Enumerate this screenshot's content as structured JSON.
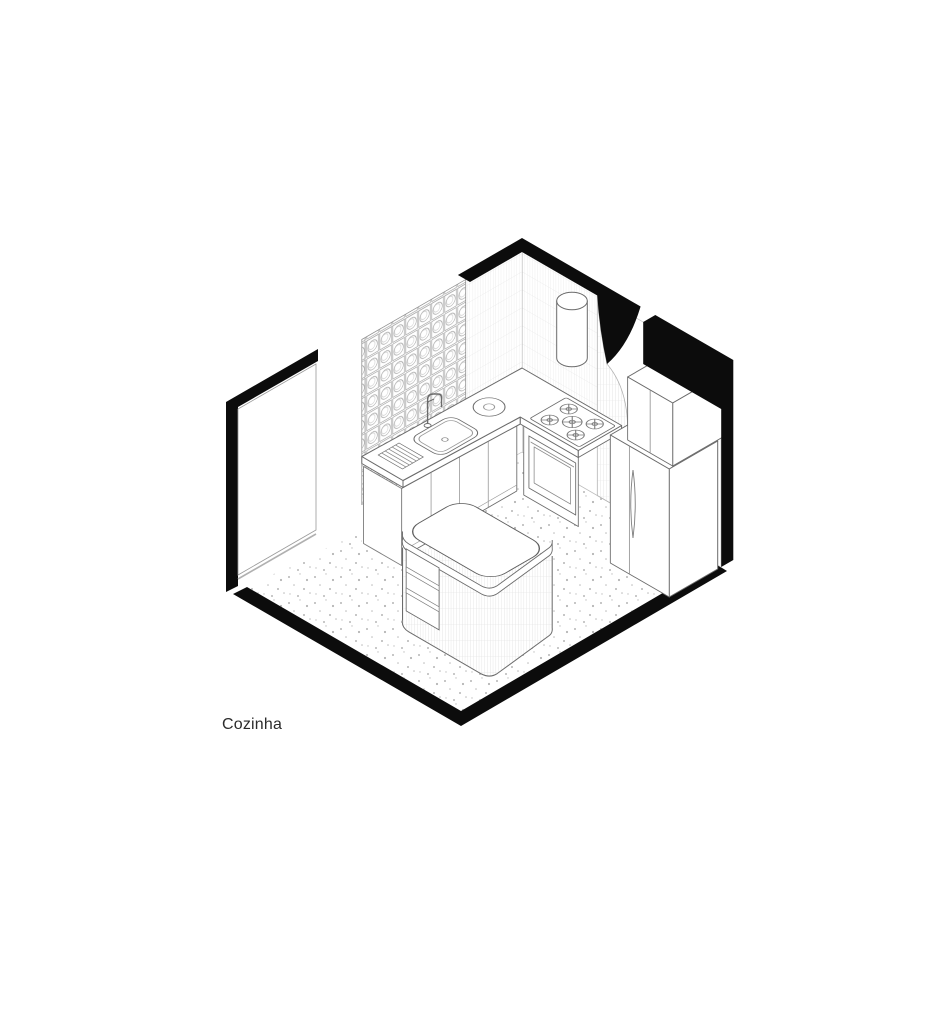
{
  "drawing": {
    "label": "Cozinha",
    "room_type": "kitchen-axonometric-cutaway",
    "style": {
      "paper": "#ffffff",
      "ink": "#0c0c0c",
      "line": "#6b6b6b",
      "thin_line": "#9a9a9a",
      "hatch": "#d8d8d8",
      "speckle": "#b5b5b5"
    },
    "elements": [
      "glass-block-wall",
      "tiled-wall",
      "curved-door-opening",
      "cylindrical-range-hood",
      "sink-counter-with-faucet",
      "dish-rack",
      "round-trivet",
      "gas-cooktop-5-burners",
      "built-in-oven",
      "base-cabinets",
      "refrigerator",
      "upper-cabinet",
      "rounded-kitchen-island-with-shelves",
      "terrazzo-floor"
    ]
  }
}
